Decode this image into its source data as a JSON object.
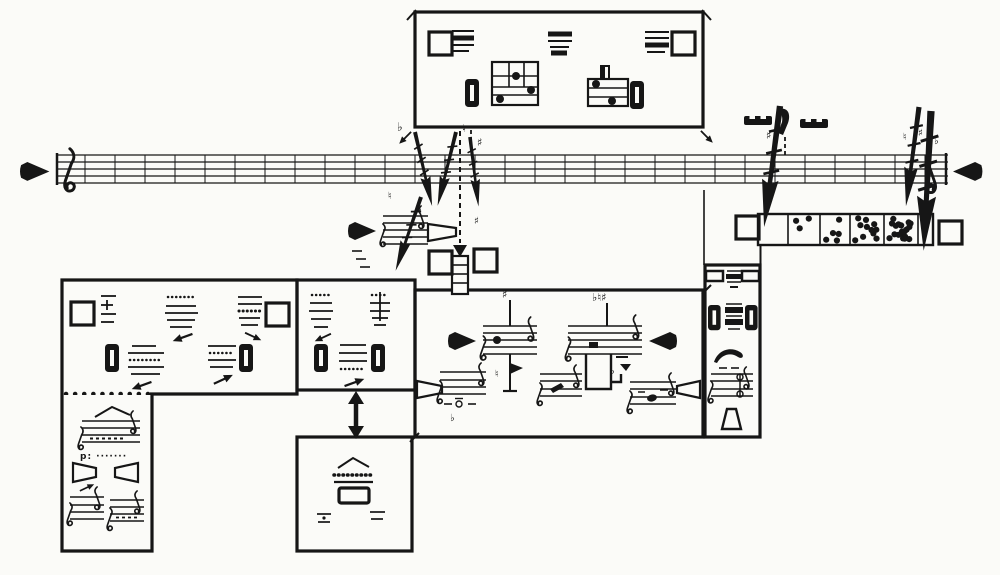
{
  "page": {
    "background": "#e9e9e6",
    "paper": "#fbfbf8",
    "ink": "#161616"
  },
  "score": {
    "kind": "graphic music score (mobile form)",
    "timeline": {
      "staff_lines": 5,
      "measures": 29,
      "start_marker": "filled-arrow-right",
      "end_marker": "filled-arrow-left",
      "start_clef": "treble",
      "end_clef": "treble-mirrored"
    },
    "glyphs": {
      "flat": "♭",
      "natural": "♮",
      "sharp": "♯",
      "flat_natural_sharp": "♭♮♯",
      "dynamic_p": "p: ·······"
    },
    "density_strip": {
      "cells": [
        0,
        3,
        5,
        11,
        19,
        0
      ]
    },
    "panels": [
      {
        "id": "top-panel",
        "symbols": [
          "open-square",
          "line-cluster",
          "slot-bar",
          "note-grid",
          "line-cluster",
          "note-grid",
          "slot-bar",
          "line-cluster",
          "open-square"
        ]
      },
      {
        "id": "left-panel",
        "symbols": [
          "open-square",
          "line-cluster-plus",
          "line-cluster",
          "line-cluster",
          "open-square",
          "slot-bar",
          "line-cluster",
          "line-cluster",
          "slot-bar",
          "small-arrows"
        ]
      },
      {
        "id": "left-lower-panel",
        "symbols": [
          "caret",
          "mini-staff",
          "dynamic-text",
          "open-trapezoid-right",
          "open-trapezoid-left",
          "small-arrow",
          "mini-staff",
          "mini-staff"
        ]
      },
      {
        "id": "middle-panel",
        "symbols": [
          "line-cluster",
          "line-cluster-dagger",
          "slot-bar",
          "line-cluster",
          "slot-bar",
          "small-arrows"
        ]
      },
      {
        "id": "bottom-middle-panel",
        "symbols": [
          "caret",
          "dotted-cluster",
          "open-frame",
          "tick-marks"
        ]
      },
      {
        "id": "center-panel",
        "symbols": [
          "filled-arrow-right",
          "filled-arrow-left",
          "open-trapezoid-right",
          "open-trapezoid-left",
          "mini-staff-stem-sharp",
          "mini-staff-accidentals",
          "mini-staff",
          "mini-staff",
          "mini-staff"
        ]
      },
      {
        "id": "right-column-panel",
        "symbols": [
          "bracket-bar",
          "line-cluster",
          "slot-bar",
          "line-cluster",
          "slot-bar",
          "hat-curve",
          "mini-staff",
          "open-bell-up"
        ]
      },
      {
        "id": "density-panel",
        "symbols": [
          "open-square",
          "dot-density-cells",
          "open-square"
        ]
      }
    ],
    "connectors": [
      "thick-glissando-arrows",
      "dashed-drop-lines",
      "double-headed-vertical-arrow",
      "corner-ticks",
      "dotted-boundary"
    ]
  }
}
